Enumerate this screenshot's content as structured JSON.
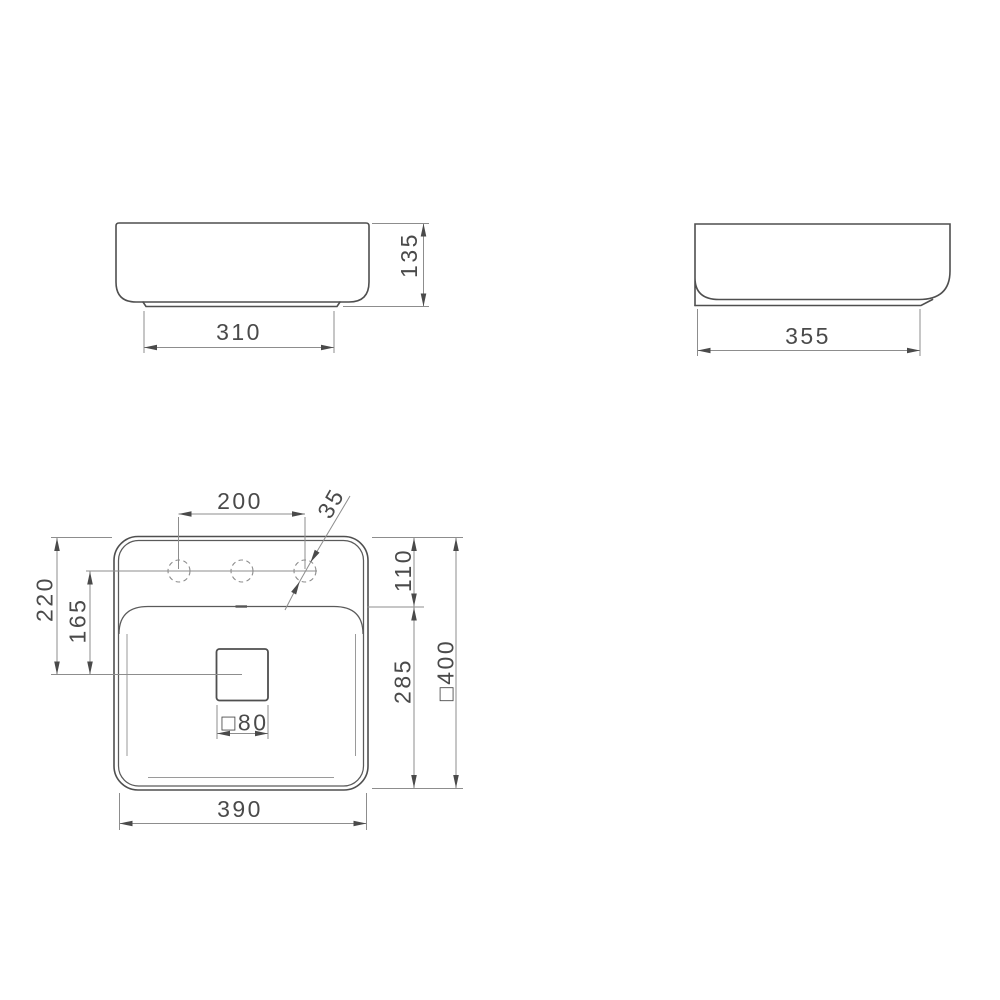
{
  "canvas": {
    "background": "#ffffff",
    "outline_color": "#4f4f4f",
    "dimension_line_color": "#8d8d8d",
    "text_color": "#4a4a4a"
  },
  "views": {
    "front": {
      "dims": {
        "height": "135",
        "base_width": "310"
      }
    },
    "side": {
      "dims": {
        "base_depth": "355"
      }
    },
    "plan": {
      "dims": {
        "tap_hole_spacing": "200",
        "tap_hole_diameter": "35",
        "rim_to_drain_center": "220",
        "tap_holes_to_drain_center": "165",
        "rim_to_bowl_edge": "110",
        "bowl_edge_to_bottom": "285",
        "overall_square_prefix": "□",
        "overall_square": "400",
        "drain_square_prefix": "□",
        "drain_square": "80",
        "base_width": "390"
      }
    }
  }
}
